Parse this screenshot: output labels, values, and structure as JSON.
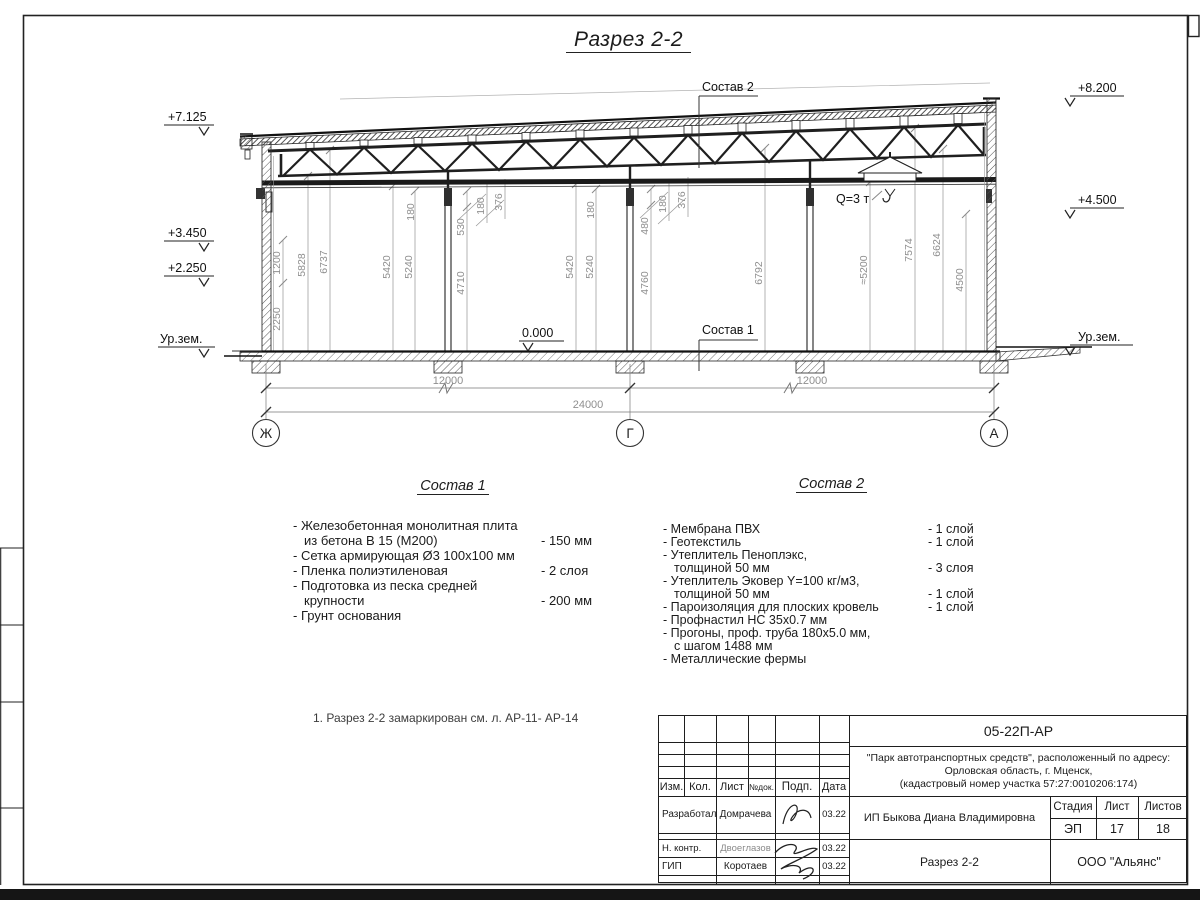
{
  "title": "Разрез 2-2",
  "note": "1. Разрез 2-2 замаркирован см. л. АР-11- АР-14",
  "section": {
    "elevations": [
      "+7.125",
      "+3.450",
      "+2.250",
      "+8.200",
      "+4.500"
    ],
    "ground_label_left": "Ур.зем.",
    "ground_label_right": "Ур.зем.",
    "zero_level": "0.000",
    "crane_capacity": "Q=3 т",
    "comp1_ref": "Состав 1",
    "comp2_ref": "Состав 2",
    "axes": [
      "Ж",
      "Г",
      "А"
    ],
    "dims_h": [
      "12000",
      "12000",
      "24000"
    ],
    "vdims": [
      "1200",
      "2250",
      "5828",
      "6737",
      "5420",
      "5240",
      "180",
      "530",
      "4710",
      "180",
      "376",
      "5420",
      "5240",
      "180",
      "480",
      "4760",
      "180",
      "376",
      "6792",
      "≈5200",
      "7574",
      "6624",
      "4500"
    ]
  },
  "comp1": {
    "title": "Состав 1",
    "items": [
      {
        "l1": "- Железобетонная  монолитная плита",
        "l2": "из бетона В 15 (М200)",
        "v": "- 150 мм"
      },
      {
        "l1": "- Сетка армирующая Ø3 100х100 мм",
        "l2": "",
        "v": ""
      },
      {
        "l1": "- Пленка полиэтиленовая",
        "l2": "",
        "v": "-  2 слоя"
      },
      {
        "l1": "- Подготовка из песка средней",
        "l2": "крупности",
        "v": "- 200 мм"
      },
      {
        "l1": "- Грунт основания",
        "l2": "",
        "v": ""
      }
    ]
  },
  "comp2": {
    "title": "Состав 2",
    "items": [
      {
        "l1": "- Мембрана ПВХ",
        "l2": "",
        "v": "- 1 слой"
      },
      {
        "l1": "- Геотекстиль",
        "l2": "",
        "v": "- 1 слой"
      },
      {
        "l1": "- Утеплитель Пеноплэкс,",
        "l2": "толщиной 50 мм",
        "v": "- 3 слоя"
      },
      {
        "l1": "- Утеплитель Эковер Y=100 кг/м3,",
        "l2": "толщиной 50 мм",
        "v": "- 1 слой"
      },
      {
        "l1": "- Пароизоляция для плоских кровель",
        "l2": "",
        "v": "- 1 слой"
      },
      {
        "l1": "- Профнастил НС 35х0.7 мм",
        "l2": "",
        "v": ""
      },
      {
        "l1": "- Прогоны, проф. труба 180х5.0 мм,",
        "l2": "с шагом 1488 мм",
        "v": ""
      },
      {
        "l1": "- Металлические фермы",
        "l2": "",
        "v": ""
      }
    ]
  },
  "tb": {
    "code": "05-22П-АР",
    "project": [
      "\"Парк автотранспортных средств\",  расположенный по адресу:",
      "Орловская область, г. Мценск,",
      "(кадастровый номер участка 57:27:0010206:174)"
    ],
    "cols": [
      "Изм.",
      "Кол.",
      "Лист",
      "№док.",
      "Подп.",
      "Дата"
    ],
    "rows": [
      {
        "role": "Разработал",
        "name": "Домрачева",
        "date": "03.22"
      },
      {
        "role": "Н. контр.",
        "name": "Двоеглазов",
        "date": "03.22"
      },
      {
        "role": "ГИП",
        "name": "Коротаев",
        "date": "03.22"
      }
    ],
    "client": "ИП Быкова Диана Владимировна",
    "stage_h": "Стадия",
    "sheet_h": "Лист",
    "sheets_h": "Листов",
    "stage": "ЭП",
    "sheet": "17",
    "sheets": "18",
    "doc_title": "Разрез 2-2",
    "company": "ООО \"Альянс\""
  }
}
